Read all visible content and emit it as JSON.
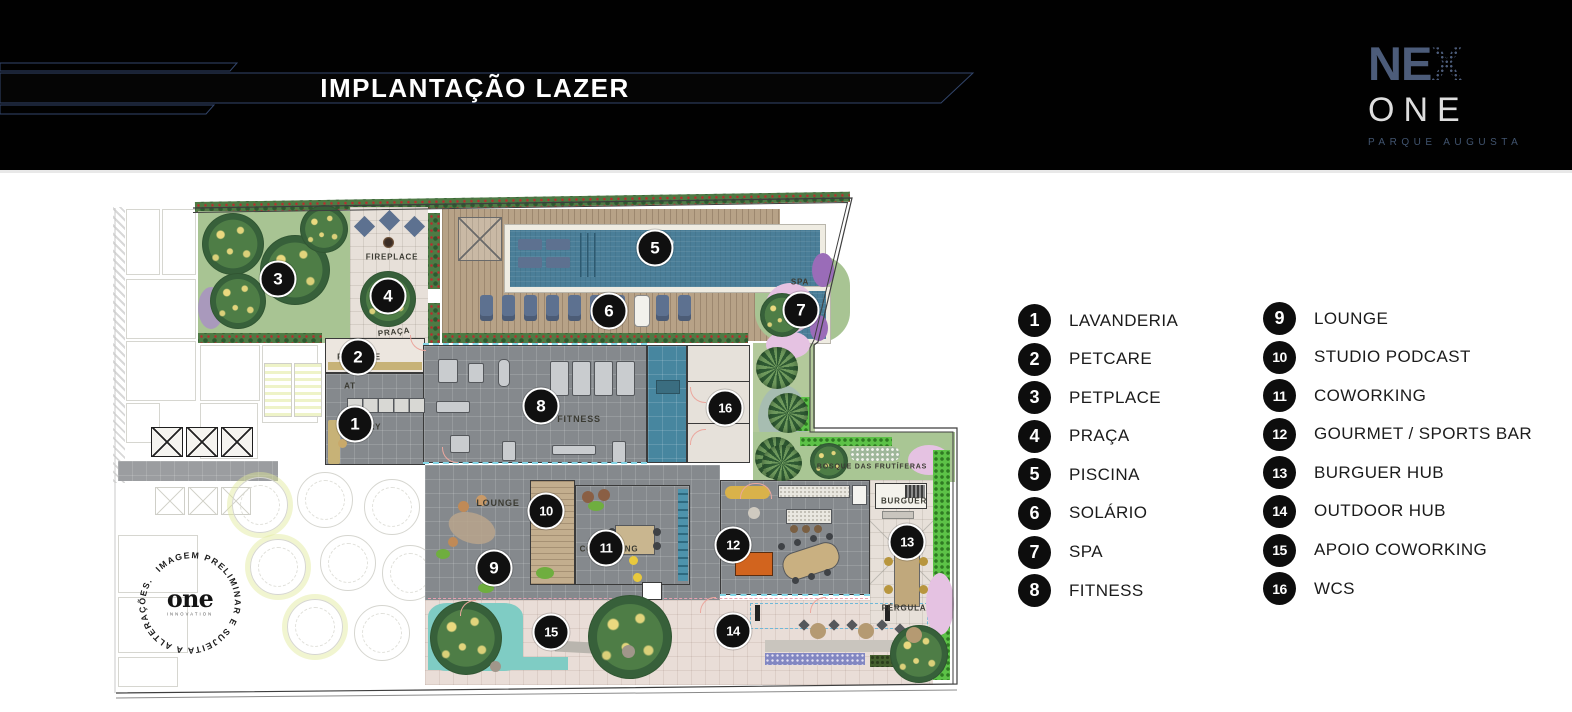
{
  "header": {
    "title": "IMPLANTAÇÃO LAZER"
  },
  "logo": {
    "name": "NE",
    "name_x": "X",
    "line2": "ONE",
    "tagline": "PARQUE AUGUSTA"
  },
  "legend": {
    "columns": [
      {
        "items": [
          {
            "num": "1",
            "label": "LAVANDERIA"
          },
          {
            "num": "2",
            "label": "PETCARE"
          },
          {
            "num": "3",
            "label": "PETPLACE"
          },
          {
            "num": "4",
            "label": "PRAÇA"
          },
          {
            "num": "5",
            "label": "PISCINA"
          },
          {
            "num": "6",
            "label": "SOLÁRIO"
          },
          {
            "num": "7",
            "label": "SPA"
          },
          {
            "num": "8",
            "label": "FITNESS"
          }
        ]
      },
      {
        "items": [
          {
            "num": "9",
            "label": "LOUNGE"
          },
          {
            "num": "10",
            "label": "STUDIO PODCAST"
          },
          {
            "num": "11",
            "label": "COWORKING"
          },
          {
            "num": "12",
            "label": "GOURMET / SPORTS BAR"
          },
          {
            "num": "13",
            "label": "BURGUER HUB"
          },
          {
            "num": "14",
            "label": "OUTDOOR HUB"
          },
          {
            "num": "15",
            "label": "APOIO COWORKING"
          },
          {
            "num": "16",
            "label": "WCS"
          }
        ]
      }
    ]
  },
  "plan": {
    "markers": [
      {
        "n": "1",
        "x": 245,
        "y": 229
      },
      {
        "n": "2",
        "x": 248,
        "y": 162
      },
      {
        "n": "3",
        "x": 168,
        "y": 84
      },
      {
        "n": "4",
        "x": 278,
        "y": 101
      },
      {
        "n": "5",
        "x": 545,
        "y": 53
      },
      {
        "n": "6",
        "x": 499,
        "y": 116
      },
      {
        "n": "7",
        "x": 691,
        "y": 115
      },
      {
        "n": "8",
        "x": 431,
        "y": 211
      },
      {
        "n": "9",
        "x": 384,
        "y": 373
      },
      {
        "n": "10",
        "x": 436,
        "y": 316
      },
      {
        "n": "11",
        "x": 496,
        "y": 353
      },
      {
        "n": "12",
        "x": 623,
        "y": 350
      },
      {
        "n": "13",
        "x": 797,
        "y": 347
      },
      {
        "n": "14",
        "x": 623,
        "y": 436
      },
      {
        "n": "15",
        "x": 441,
        "y": 437
      },
      {
        "n": "16",
        "x": 615,
        "y": 213
      }
    ],
    "labels": [
      {
        "text": "FIREPLACE",
        "x": 282,
        "y": 62,
        "size": 8
      },
      {
        "text": "PRAÇA",
        "x": 284,
        "y": 137,
        "size": 8,
        "rot": -6
      },
      {
        "text": "SPA",
        "x": 690,
        "y": 87,
        "size": 8
      },
      {
        "text": "AT",
        "x": 240,
        "y": 191,
        "size": 8
      },
      {
        "text": "FITNESS",
        "x": 469,
        "y": 224,
        "size": 9
      },
      {
        "text": "LOUNGE",
        "x": 388,
        "y": 308,
        "size": 9
      },
      {
        "text": "PETCARE",
        "x": 249,
        "y": 162,
        "size": 8
      },
      {
        "text": "LAUNDRY",
        "x": 249,
        "y": 232,
        "size": 8
      },
      {
        "text": "COWORKING",
        "x": 499,
        "y": 354,
        "size": 8
      },
      {
        "text": "BOSQUE DAS FRUTÍFERAS",
        "x": 762,
        "y": 272,
        "size": 7
      },
      {
        "text": "BURGUER",
        "x": 794,
        "y": 306,
        "size": 8
      },
      {
        "text": "PÉRGULA",
        "x": 794,
        "y": 413,
        "size": 8
      }
    ],
    "watermark": {
      "arc_text": "IMAGEM PRELIMINAR E SUJEITA A ALTERAÇÕES.",
      "brand": "one",
      "brand_sub": "INNOVATION"
    }
  },
  "palette": {
    "header_bg": "#010101",
    "header_accent_line": "#32456b",
    "title_color": "#ffffff",
    "logo_nex": "#4c5c7a",
    "logo_one": "#dedede",
    "logo_tagline": "#41546f",
    "badge_bg": "#0d0d0d",
    "legend_text": "#1b1b1b",
    "pool": "#4a7e98",
    "deck_wood": "#b7a287",
    "floor_gray": "#85898d",
    "grass_green": "#a8c493",
    "teal_groundcover": "#7fccc4",
    "vivid_hedge": "#5cc247",
    "pool_table_orange": "#d2641e",
    "pink_tree": "#e5c2e2",
    "counter_gold": "#c7b277"
  }
}
